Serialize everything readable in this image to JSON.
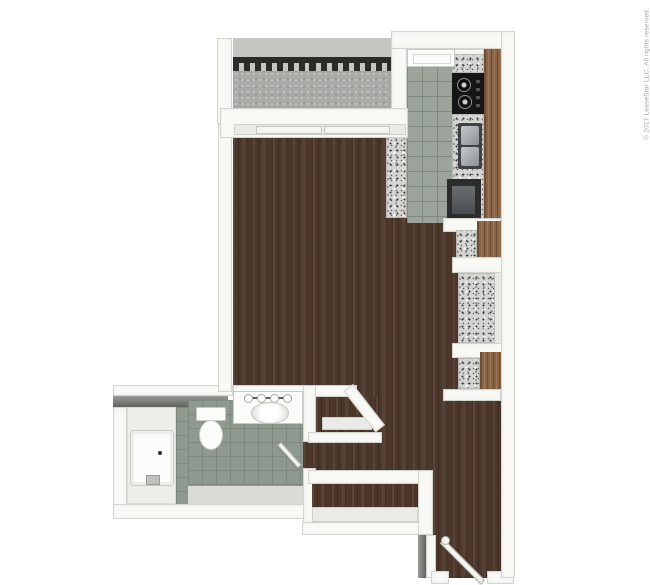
{
  "watermark": {
    "text": "© 2017 LeaseStar LLC. All rights reserved."
  },
  "palette": {
    "background": "#ffffff",
    "wall_face": "#f8f8f5",
    "wall_edge": "#d4d4cf",
    "wood": "#4d372b",
    "cabinet": "#8a6547",
    "tile_kitchen": "#9ca49b",
    "tile_bath": "#8f998f",
    "tile_line": "#7f8a7e",
    "granite": "#d4d4d2",
    "concrete": "#a9a9a6",
    "parapet": "#c5c5c1",
    "railing": "#2b2b28",
    "appliance_dark": "#161616",
    "fridge": "#2c2c2c",
    "steel": "#b0b5b7",
    "fixture_white": "#fbfbf9",
    "dark_top_a": "#999c96",
    "dark_top_b": "#5f625e",
    "watermark_color": "#a3a3a3"
  },
  "floorplan": {
    "view": "3d-top-down-floor-plan",
    "rooms": [
      "balcony",
      "living-room",
      "kitchen",
      "bathroom",
      "closets",
      "entry"
    ]
  }
}
